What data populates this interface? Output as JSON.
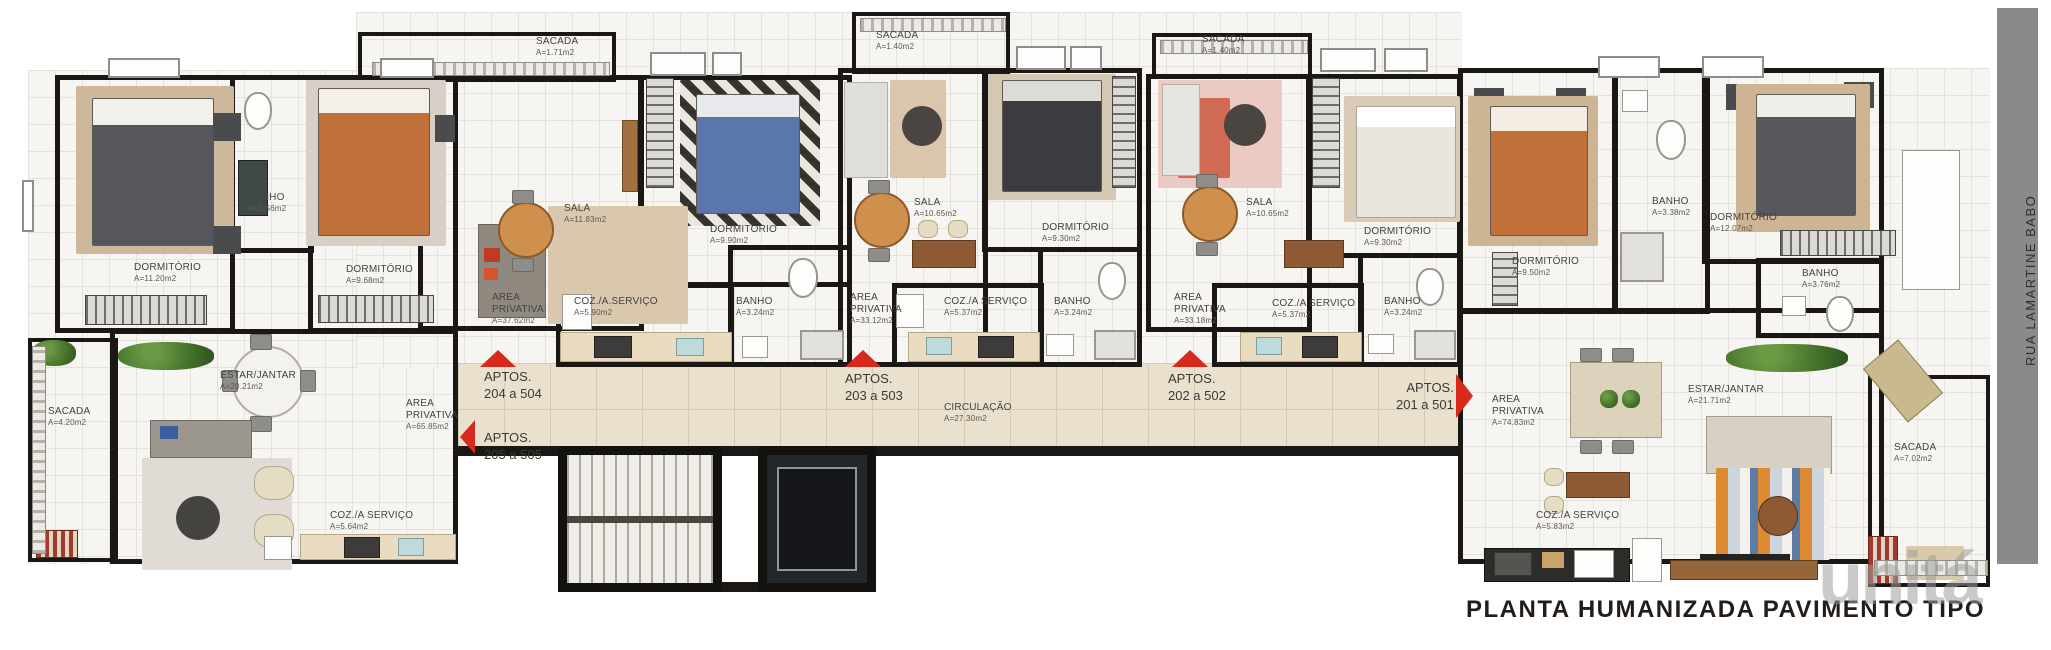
{
  "title": "PLANTA HUMANIZADA PAVIMENTO TIPO",
  "street": "RUA LAMARTINE BABO",
  "watermark": "unitá",
  "colors": {
    "wall": "#1a1714",
    "corridor_floor": "#e9e0cd",
    "accent_red": "#d8291d",
    "street_bar": "#8a8a8a"
  },
  "circulation": {
    "name": "CIRCULAÇÃO",
    "area": "A=27.30m2"
  },
  "apartments": {
    "a205": {
      "entrance": {
        "line1": "APTOS.",
        "line2": "205 a 505"
      },
      "rooms": {
        "sacada": {
          "name": "SACADA",
          "area": "A=4.20m2"
        },
        "dorm1": {
          "name": "DORMITÓRIO",
          "area": "A=11.20m2"
        },
        "banho": {
          "name": "BANHO",
          "area": "A=3.56m2"
        },
        "dorm2": {
          "name": "DORMITÓRIO",
          "area": "A=9.68m2"
        },
        "estar": {
          "name": "ESTAR/JANTAR",
          "area": "A=20.21m2"
        },
        "area_priv": {
          "name": "AREA PRIVATIVA",
          "area": "A=65.85m2"
        },
        "coz": {
          "name": "COZ./A SERVIÇO",
          "area": "A=5.64m2"
        }
      }
    },
    "a204": {
      "entrance": {
        "line1": "APTOS.",
        "line2": "204 a 504"
      },
      "rooms": {
        "sacada": {
          "name": "SACADA",
          "area": "A=1.71m2"
        },
        "sala": {
          "name": "SALA",
          "area": "A=11.83m2"
        },
        "dorm": {
          "name": "DORMITÓRIO",
          "area": "A=9.90m2"
        },
        "area_priv": {
          "name": "AREA PRIVATIVA",
          "area": "A=37.62m2"
        },
        "coz": {
          "name": "COZ./A.SERVIÇO",
          "area": "A=5.90m2"
        },
        "banho": {
          "name": "BANHO",
          "area": "A=3.24m2"
        }
      }
    },
    "a203": {
      "entrance": {
        "line1": "APTOS.",
        "line2": "203 a 503"
      },
      "rooms": {
        "sacada": {
          "name": "SACADA",
          "area": "A=1.40m2"
        },
        "sala": {
          "name": "SALA",
          "area": "A=10.65m2"
        },
        "dorm": {
          "name": "DORMITÓRIO",
          "area": "A=9.30m2"
        },
        "area_priv": {
          "name": "AREA PRIVATIVA",
          "area": "A=33.12m2"
        },
        "coz": {
          "name": "COZ./A SERVIÇO",
          "area": "A=5.37m2"
        },
        "banho": {
          "name": "BANHO",
          "area": "A=3.24m2"
        }
      }
    },
    "a202": {
      "entrance": {
        "line1": "APTOS.",
        "line2": "202 a 502"
      },
      "rooms": {
        "sacada": {
          "name": "SACADA",
          "area": "A=1.40m2"
        },
        "sala": {
          "name": "SALA",
          "area": "A=10.65m2"
        },
        "dorm": {
          "name": "DORMITÓRIO",
          "area": "A=9.30m2"
        },
        "area_priv": {
          "name": "AREA PRIVATIVA",
          "area": "A=33.18m2"
        },
        "coz": {
          "name": "COZ./A SERVIÇO",
          "area": "A=5.37m2"
        },
        "banho": {
          "name": "BANHO",
          "area": "A=3.24m2"
        }
      }
    },
    "a201": {
      "entrance": {
        "line1": "APTOS.",
        "line2": "201 a 501"
      },
      "rooms": {
        "dorm1": {
          "name": "DORMITÓRIO",
          "area": "A=9.50m2"
        },
        "banho1": {
          "name": "BANHO",
          "area": "A=3.38m2"
        },
        "dorm2": {
          "name": "DORMITÓRIO",
          "area": "A=12.07m2"
        },
        "banho2": {
          "name": "BANHO",
          "area": "A=3.76m2"
        },
        "estar": {
          "name": "ESTAR/JANTAR",
          "area": "A=21.71m2"
        },
        "area_priv": {
          "name": "AREA PRIVATIVA",
          "area": "A=74.83m2"
        },
        "sacada": {
          "name": "SACADA",
          "area": "A=7.02m2"
        },
        "coz": {
          "name": "COZ./A SERVIÇO",
          "area": "A=5.83m2"
        }
      }
    }
  }
}
